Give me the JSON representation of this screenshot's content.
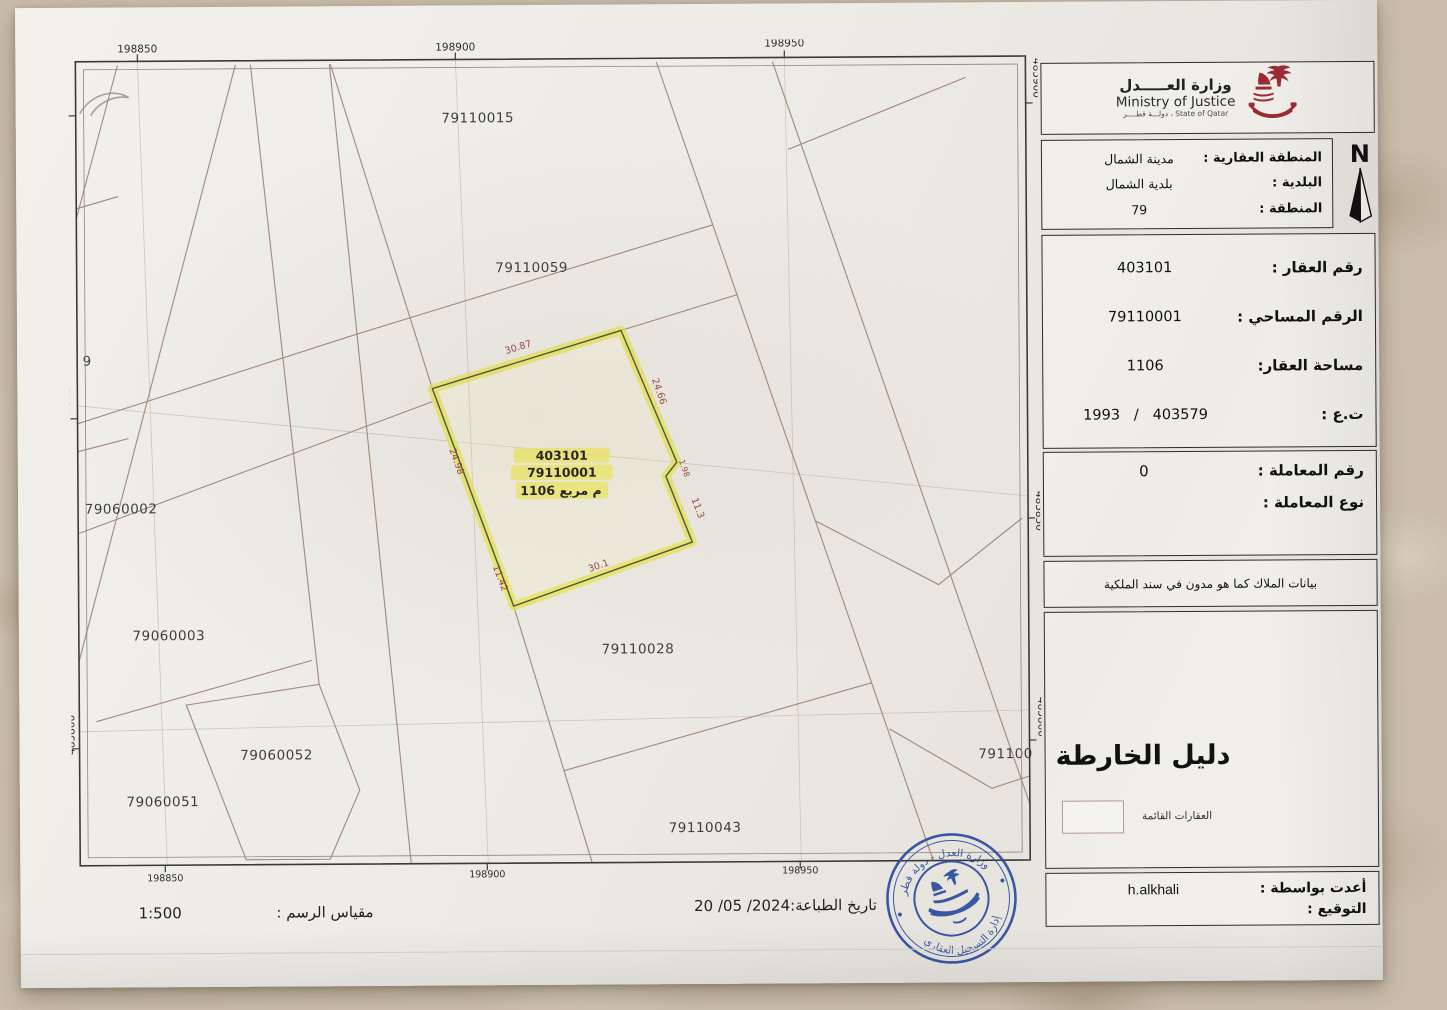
{
  "header": {
    "ministry_name_ar": "وزارة العـــــدل",
    "ministry_name_en": "Ministry of Justice",
    "ministry_tagline": "State of Qatar ، دولـــة قطــــر",
    "north_letter": "N"
  },
  "info": {
    "zone_section": [
      {
        "label": "المنطقة العقارية :",
        "value": "مدينة الشمال"
      },
      {
        "label": "البلدية :",
        "value": "بلدية الشمال"
      },
      {
        "label": "المنطقة :",
        "value": "79"
      }
    ],
    "property_section": [
      {
        "label": "رقم العقار :",
        "value": "403101"
      },
      {
        "label": "الرقم المساحي :",
        "value": "79110001"
      },
      {
        "label": "مساحة العقار:",
        "value": "1106"
      },
      {
        "label": "ت.ع :",
        "value": "403579   /   1993"
      }
    ],
    "transaction_section": [
      {
        "label": "رقم المعاملة :",
        "value": "0"
      },
      {
        "label": "نوع المعاملة :",
        "value": ""
      }
    ],
    "owners_note": "بيانات الملاك كما هو مدون في سند الملكية",
    "prepared_section": [
      {
        "label": "أعدت بواسطة :",
        "value": "h.alkhali"
      },
      {
        "label": "التوقيع :",
        "value": ""
      }
    ]
  },
  "legend": {
    "title": "دليل الخارطة",
    "existing_properties": "العقارات القائمة"
  },
  "footer": {
    "scale_label": "مقياس الرسم :",
    "scale_value": "1:500",
    "print_date_label": "تاريخ الطباعة:",
    "print_date_value": "20 /05 /2024"
  },
  "map": {
    "coords": {
      "top": [
        "198850",
        "198900",
        "198950"
      ],
      "bottom": [
        "198850",
        "198900",
        "198950"
      ],
      "left": [
        "485900",
        "485850",
        "485800"
      ],
      "right": [
        "485900",
        "485850",
        "485800"
      ]
    },
    "parcels": {
      "p15": "79110015",
      "p59": "79110059",
      "p02": "79060002",
      "p03": "79060003",
      "p52": "79060052",
      "p51": "79060051",
      "p28": "79110028",
      "p43": "79110043",
      "p100": "791100",
      "p9": "9"
    },
    "highlight": {
      "plot": "403101",
      "survey": "79110001",
      "area": "1106 م مربع"
    },
    "dims": {
      "d1": "30.87",
      "d2": "24.66",
      "d3": "1.98",
      "d4": "11.3",
      "d5": "30.1",
      "d6": "11.42",
      "d7": "24.98"
    }
  },
  "stamp": {
    "text_top": "وزارة العدل - دولة قطر",
    "text_bottom": "إدارة التسجيل العقاري"
  },
  "colors": {
    "accent_maroon": "#7e1536",
    "stamp_blue": "#2b4da0",
    "highlight_yellow": "#efe95e"
  }
}
